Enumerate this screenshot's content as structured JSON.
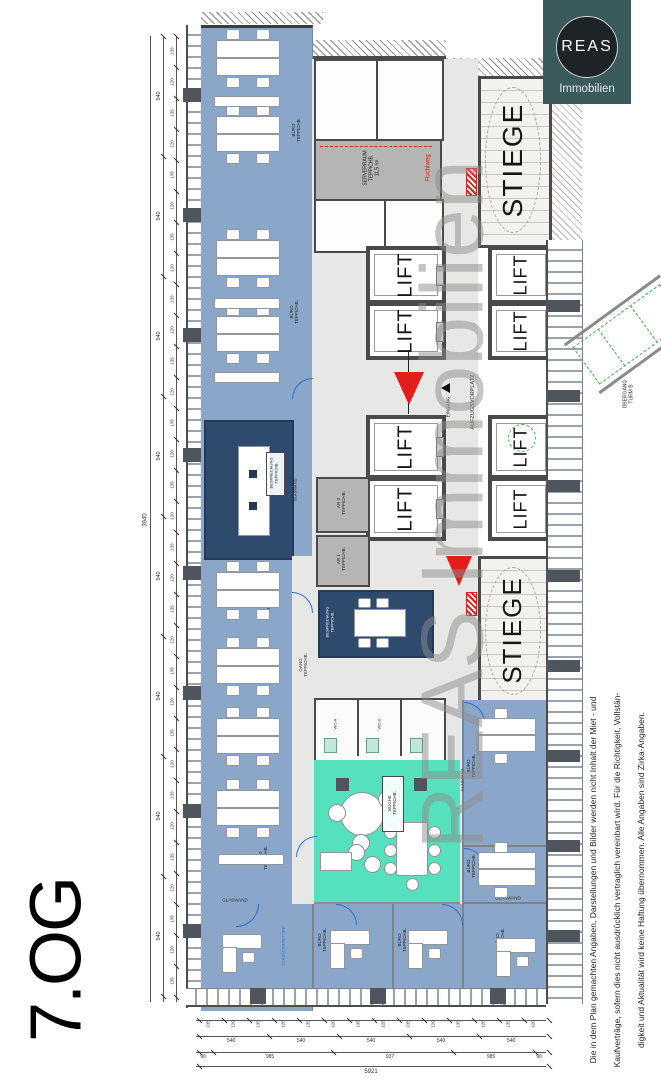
{
  "floor_label": "7.OG",
  "logo": {
    "brand": "REAS",
    "subtitle": "Immobilien"
  },
  "watermark": "REAS Immobilien",
  "disclaimer": {
    "line1": "Die in dem Plan gemachten Angaben, Darstellungen und Bilder werden nicht Inhalt der Miet - und",
    "line2": "Kaufverträge, sofern dies nicht ausdrücklich vertraglich vereinbart wird. Für die Richtigkeit, Vollstän-",
    "line3": "digkeit und Aktualität wird keine Haftung übernommen. Alle Angaben sind Zirka-Angaben."
  },
  "labels": {
    "stiege": "STIEGE",
    "lift": "LIFT",
    "kueche": "KÜCHE",
    "floor_covering": "TEPPICHB.",
    "besprechung": "BESPRECHUNG",
    "serverraum": "SERVERRAUM",
    "serverraum_area": "11,5 m²",
    "fluchtweg": "Fluchtweg",
    "eingang": "EINGANG",
    "aufzugsvorplatz": "AUFZUGSVORPLATZ",
    "uebergang": "ÜBERGANG",
    "turm": "TURM B",
    "buero": "BÜRO",
    "gang": "GANG",
    "glaswand": "GLASWAND",
    "glasschiebetuer": "GLASSCHIEBETÜRE",
    "wc_h": "WC-H",
    "wc_d": "WC-D",
    "ar1": "AR 1",
    "ar3": "AR 3"
  },
  "dimensions": {
    "left_total": "3940",
    "segment": "540",
    "small_a": "135",
    "small_b": "120",
    "bottom_total": "5921",
    "bottom_groups": [
      "90",
      "985",
      "937",
      "985",
      "90"
    ]
  },
  "colors": {
    "office_blue": "#8aa6c8",
    "meeting_blue": "#2e4a6c",
    "kitchen_teal": "#55e0be",
    "corridor_gray": "#e7e7e6",
    "wall_gray": "#4a4a4a",
    "marker_red": "#e31c1c",
    "logo_teal": "#3b5a5c",
    "watermark_gray": "#8d8d8d",
    "door_blue": "#2e6fd2",
    "bridge_green": "#41b649"
  }
}
